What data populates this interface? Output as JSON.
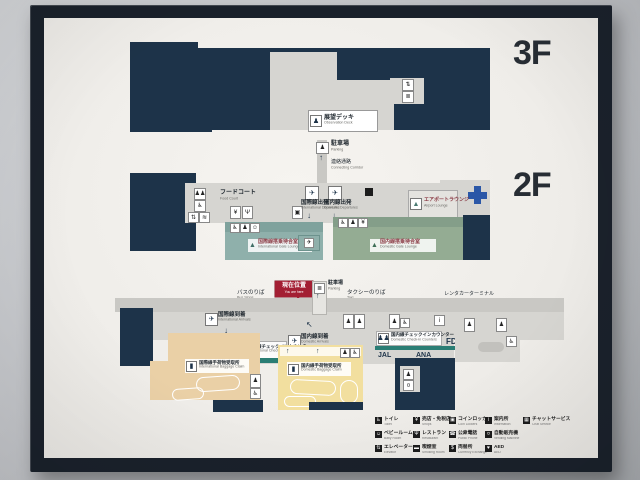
{
  "colors": {
    "map_navy": "#1d3349",
    "lounge_teal": "#8fb0ab",
    "lounge_green": "#94ac93",
    "baggage_tan": "#ead0a6",
    "baggage_yellow": "#f2df9f",
    "counter_teal": "#2a7d74",
    "you_are_here_red": "#a31f33",
    "clinic_cross_blue": "#2b57a7",
    "frame_black": "#1a212b"
  },
  "floor3": {
    "big": "3F",
    "observation_ja": "展望デッキ",
    "observation_en": "Observation Deck"
  },
  "connector": {
    "parking_ja": "駐車場",
    "parking_en": "Parking",
    "corridor_ja": "連絡通路",
    "corridor_en": "Connecting Corridor"
  },
  "floor2": {
    "big": "2F",
    "food_ja": "フードコート",
    "food_en": "Food Court",
    "intl_dep_ja": "国際線出発",
    "intl_dep_en": "International Departures",
    "dom_dep_ja": "国内線出発",
    "dom_dep_en": "Domestic Departures",
    "lounge_ja": "エアポートラウンジ",
    "lounge_en": "Airport Lounge",
    "intl_wait_ja": "国際線搭乗待合室",
    "intl_wait_en": "International Gate Lounge",
    "dom_wait_ja": "国内線搭乗待合室",
    "dom_wait_en": "Domestic Gate Lounge"
  },
  "floor1": {
    "big": "1F",
    "you_are_here_ja": "現在位置",
    "you_are_here_en": "You are here",
    "bus_ja": "バスのりば",
    "bus_en": "Bus Stops",
    "taxi_ja": "タクシーのりば",
    "taxi_en": "Taxi",
    "rentacar_ja": "レンタカーターミナル",
    "rentacar_en": "Rent a car Terminal",
    "parking_ja": "駐車場",
    "parking_en": "Parking",
    "intl_arr_ja": "国際線到着",
    "intl_arr_en": "International Arrivals",
    "dom_arr_ja": "国内線到着",
    "dom_arr_en": "Domestic Arrivals",
    "intl_checkin_ja": "国際線チェックインカウンター",
    "intl_checkin_en": "International Check-in Counters",
    "dom_checkin_ja": "国内線チェックインカウンター",
    "dom_checkin_en": "Domestic Check-in Counters",
    "intl_bag_ja": "国際線手荷物受取所",
    "intl_bag_en": "International Baggage Claim",
    "dom_bag_ja": "国内線手荷物受取所",
    "dom_bag_en": "Domestic Baggage Claim",
    "airlines": [
      "JAL",
      "ANA",
      "FDA"
    ]
  },
  "legend": {
    "entries": [
      {
        "glyph": "♿",
        "ja": "トイレ",
        "en": "Toilet"
      },
      {
        "glyph": "¥",
        "ja": "売店・免税店",
        "en": "Shops"
      },
      {
        "glyph": "▣",
        "ja": "コインロッカー",
        "en": "Coin Lockers"
      },
      {
        "glyph": "i",
        "ja": "案内所",
        "en": "Information"
      },
      {
        "glyph": "▦",
        "ja": "チャットサービス",
        "en": "Chat Service"
      },
      {
        "glyph": "☺",
        "ja": "ベビールーム",
        "en": "Baby Room"
      },
      {
        "glyph": "Ψ",
        "ja": "レストラン",
        "en": "Restaurant"
      },
      {
        "glyph": "☎",
        "ja": "公衆電話",
        "en": "Public Phone"
      },
      {
        "glyph": "¤",
        "ja": "自動販売機",
        "en": "Vending Machine"
      },
      {
        "glyph": "⇅",
        "ja": "エレベーター",
        "en": "Elevator"
      },
      {
        "glyph": "▬",
        "ja": "喫煙室",
        "en": "Smoking Room"
      },
      {
        "glyph": "$",
        "ja": "両替所",
        "en": "Currency Exchange"
      },
      {
        "glyph": "♥",
        "ja": "AED",
        "en": "AED"
      }
    ]
  }
}
